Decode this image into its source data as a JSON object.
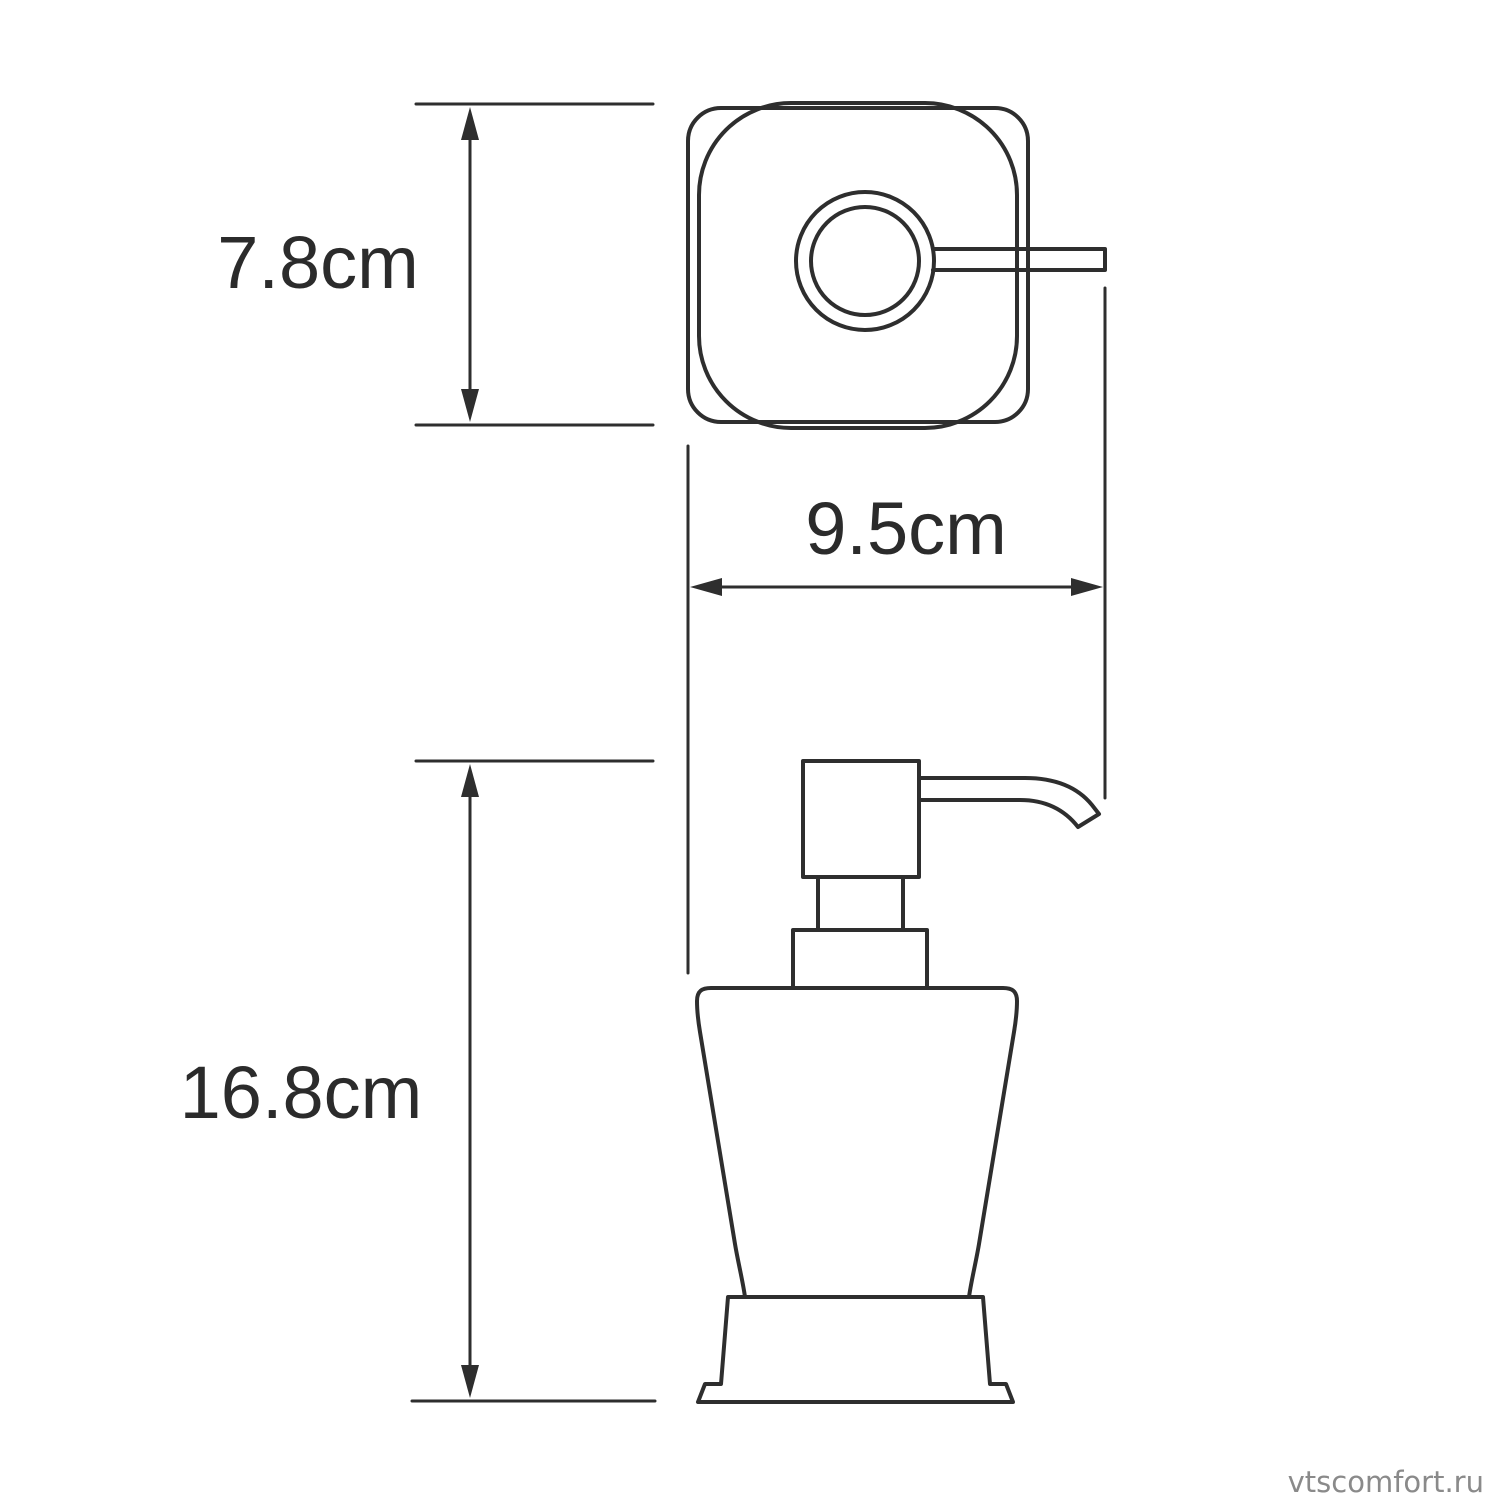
{
  "page": {
    "background_color": "#ffffff"
  },
  "drawing": {
    "line_color": "#2e2e2e",
    "label_color": "#2b2b2b"
  },
  "labels": {
    "top_view_depth": "7.8cm",
    "overall_width": "9.5cm",
    "body_height": "16.8cm"
  },
  "watermark": {
    "text": "vtscomfort.ru",
    "color": "#8a8a8a"
  }
}
